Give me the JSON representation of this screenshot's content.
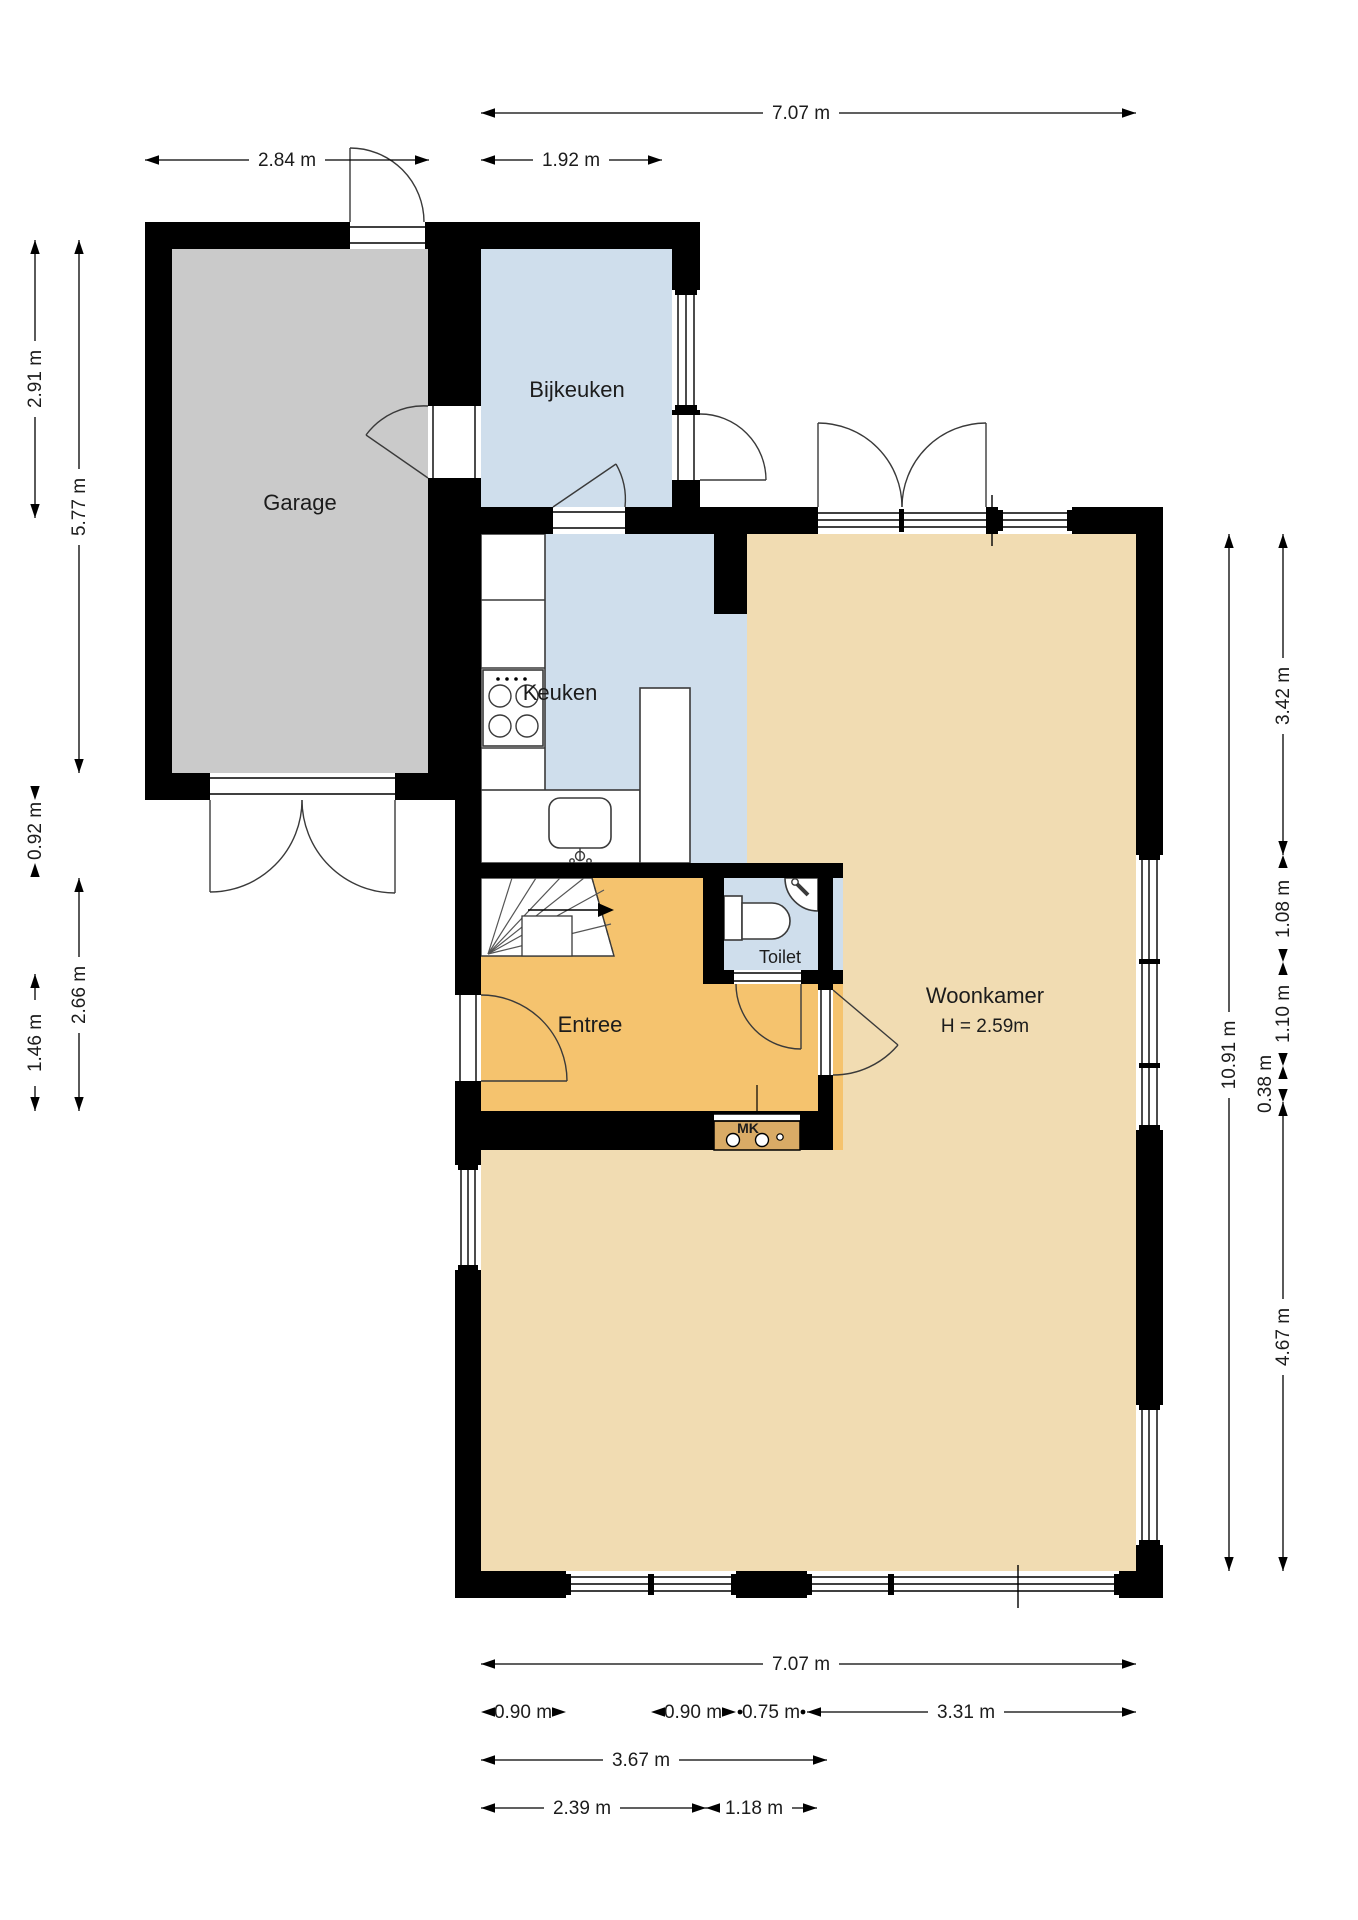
{
  "colors": {
    "wall": "#000000",
    "garage": "#cacaca",
    "wet_room": "#cfdeec",
    "entree": "#f5c36e",
    "living": "#f1dcb2",
    "meterkast": "#d9ab66",
    "background": "#ffffff"
  },
  "rooms": {
    "garage": {
      "label": "Garage"
    },
    "bijkeuken": {
      "label": "Bijkeuken"
    },
    "keuken": {
      "label": "Keuken"
    },
    "toilet": {
      "label": "Toilet"
    },
    "entree": {
      "label": "Entree"
    },
    "woonkamer": {
      "label": "Woonkamer",
      "height_note": "H = 2.59m"
    },
    "meterkast": {
      "label": "MK"
    }
  },
  "dimensions": {
    "top": [
      {
        "label": "7.07 m"
      },
      {
        "label": "2.84 m"
      },
      {
        "label": "1.92 m"
      }
    ],
    "left": [
      {
        "label": "2.91 m"
      },
      {
        "label": "5.77 m"
      },
      {
        "label": "0.92 m"
      },
      {
        "label": "2.66 m"
      },
      {
        "label": "1.46 m"
      }
    ],
    "right": [
      {
        "label": "10.91 m"
      },
      {
        "label": "3.42 m"
      },
      {
        "label": "1.08 m"
      },
      {
        "label": "1.10 m"
      },
      {
        "label": "0.38 m"
      },
      {
        "label": "4.67 m"
      }
    ],
    "bottom": [
      {
        "label": "7.07 m"
      },
      {
        "label": "0.90 m"
      },
      {
        "label": "0.90 m"
      },
      {
        "label": "0.75 m"
      },
      {
        "label": "3.31 m"
      },
      {
        "label": "3.67 m"
      },
      {
        "label": "2.39 m"
      },
      {
        "label": "1.18 m"
      }
    ]
  }
}
